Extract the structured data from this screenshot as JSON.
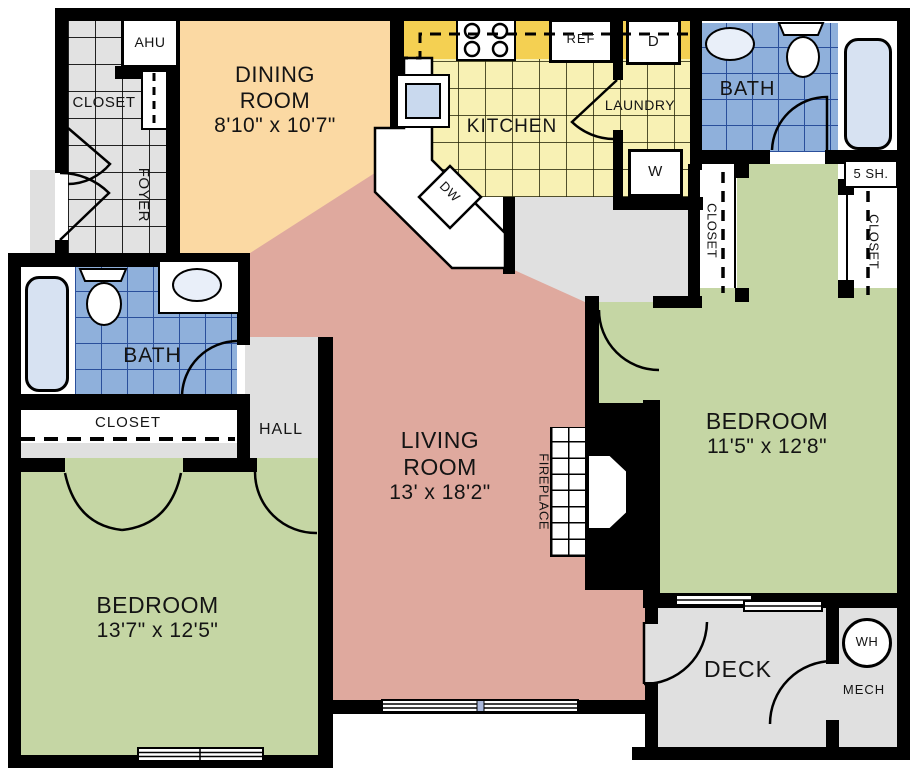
{
  "rooms": {
    "dining": {
      "line1": "DINING",
      "line2": "ROOM",
      "dims": "8'10\" x 10'7\""
    },
    "kitchen": {
      "label": "KITCHEN"
    },
    "laundry": {
      "label": "LAUNDRY"
    },
    "foyer": {
      "label": "FOYER"
    },
    "bath_top": {
      "label": "BATH"
    },
    "bath_left": {
      "label": "BATH"
    },
    "hall": {
      "label": "HALL"
    },
    "living": {
      "line1": "LIVING",
      "line2": "ROOM",
      "dims": "13' x 18'2\""
    },
    "bedroom_left": {
      "label": "BEDROOM",
      "dims": "13'7\" x 12'5\""
    },
    "bedroom_right": {
      "label": "BEDROOM",
      "dims": "11'5\" x 12'8\""
    },
    "deck": {
      "label": "DECK"
    },
    "mech": {
      "label": "MECH"
    }
  },
  "closets": {
    "foyer_closet": "CLOSET",
    "hall_closet": "CLOSET",
    "bedroom_right_left_closet": "CLOSET",
    "bedroom_right_right_closet": "CLOSET",
    "shelves": "5 SH."
  },
  "fixtures": {
    "ahu": "AHU",
    "dishwasher": "DW",
    "refrigerator": "REF",
    "dryer": "D",
    "washer": "W",
    "water_heater": "WH",
    "fireplace": "FIREPLACE"
  },
  "colors": {
    "walls": "#000000",
    "dining_floor": "#FBD9A3",
    "living_floor": "#DFA99E",
    "bedroom_floor": "#C5D6A4",
    "kitchen_floor": "#F8F1B4",
    "kitchen_counter": "#F4D052",
    "bath_tile": "#8FB0DB",
    "gray_floor": "#E0E0E0",
    "fixture_blue": "#D7E2F2",
    "window_mullion": "#A9B7DB"
  }
}
